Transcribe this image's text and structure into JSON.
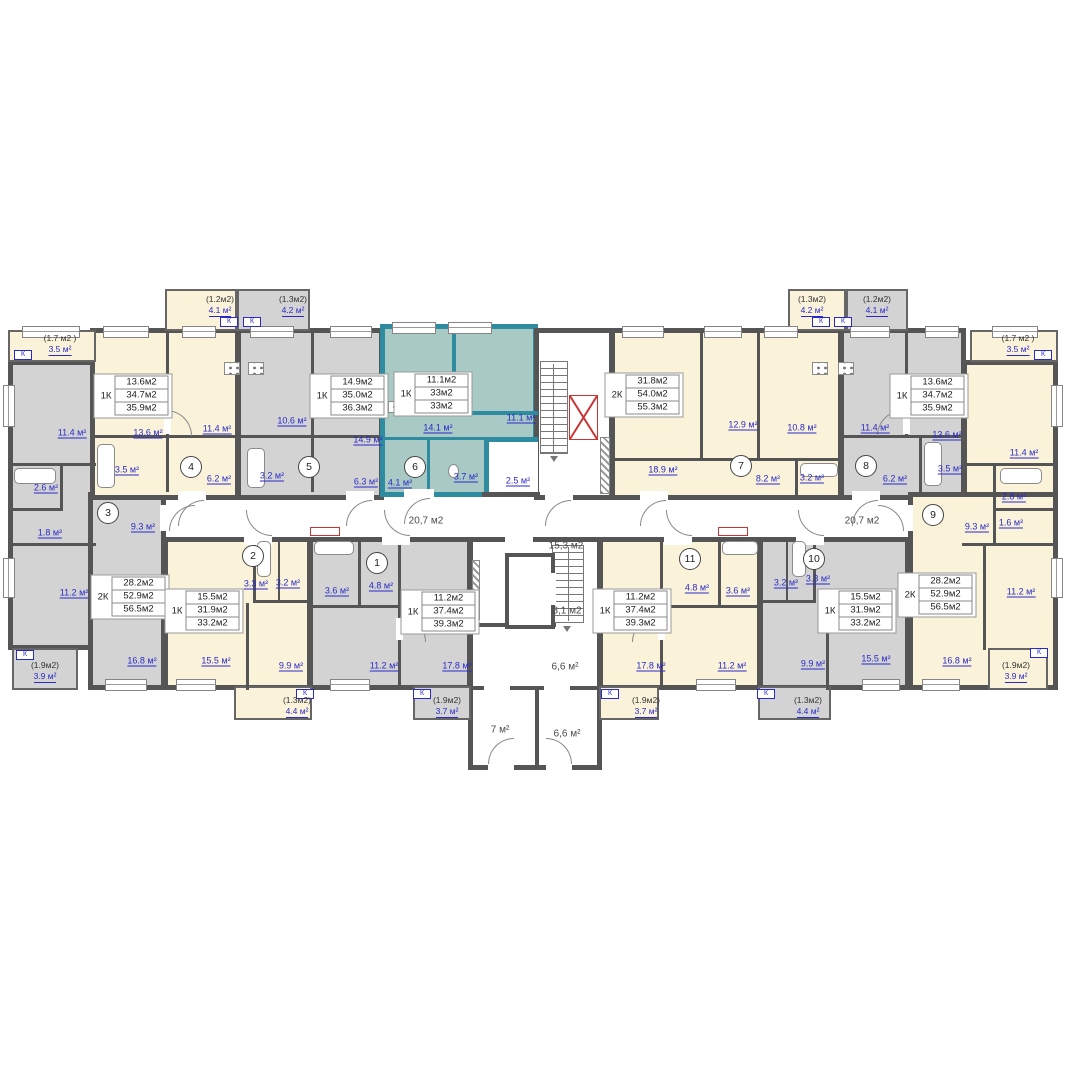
{
  "plan": {
    "units": {
      "1": {
        "num": "1",
        "kind": "1К",
        "table": [
          "11.2м2",
          "37.4м2",
          "39.3м2"
        ],
        "rooms": [
          "3.6 м²",
          "4.8 м²",
          "11.2 м²",
          "17.8 м²"
        ],
        "balcony_head": "(1.9м2)",
        "balcony_area": "3.7 м²"
      },
      "2": {
        "num": "2",
        "kind": "1К",
        "table": [
          "15.5м2",
          "31.9м2",
          "33.2м2"
        ],
        "rooms": [
          "3.3 м²",
          "3.2 м²",
          "9.9 м²",
          "15.5 м²"
        ],
        "balcony_head": "(1.3м2)",
        "balcony_area": "4.4 м²"
      },
      "3": {
        "num": "3",
        "kind": "2К",
        "table": [
          "28.2м2",
          "52.9м2",
          "56.5м2"
        ],
        "rooms": [
          "11.4 м²",
          "2.6 м²",
          "1.8 м²",
          "9.3 м²",
          "11.2 м²",
          "16.8 м²"
        ],
        "balcony_head": "(1.9м2)",
        "balcony_area": "3.9 м²"
      },
      "4": {
        "num": "4",
        "kind": "1К",
        "table": [
          "13.6м2",
          "34.7м2",
          "35.9м2"
        ],
        "rooms": [
          "13.6 м²",
          "11.4 м²",
          "3.5 м²",
          "6.2 м²"
        ],
        "balcony_head": "(1.2м2)",
        "balcony_area": "4.1 м²"
      },
      "5": {
        "num": "5",
        "kind": "1К",
        "table": [
          "14.9м2",
          "35.0м2",
          "36.3м2"
        ],
        "rooms": [
          "10.6 м²",
          "14.9 м²",
          "3.2 м²",
          "6.3 м²"
        ],
        "balcony_head": "(1.3м2)",
        "balcony_area": "4.2 м²"
      },
      "6": {
        "num": "6",
        "kind": "1К",
        "table": [
          "11.1м2",
          "33м2",
          "33м2"
        ],
        "rooms": [
          "14.1 м²",
          "11.1 м²",
          "4.1 м²",
          "3.7 м²"
        ]
      },
      "7": {
        "num": "7",
        "kind": "2К",
        "table": [
          "31.8м2",
          "54.0м2",
          "55.3м2"
        ],
        "rooms": [
          "18.9 м²",
          "12.9 м²",
          "10.8 м²",
          "8.2 м²",
          "3.2 м²"
        ],
        "balcony_head": "(1.3м2)",
        "balcony_area": "4.2 м²"
      },
      "8": {
        "num": "8",
        "kind": "1К",
        "table": [
          "13.6м2",
          "34.7м2",
          "35.9м2"
        ],
        "rooms": [
          "11.4 м²",
          "13.6 м²",
          "6.2 м²",
          "3.5 м²"
        ],
        "balcony_head": "(1.2м2)",
        "balcony_area": "4.1 м²"
      },
      "9": {
        "num": "9",
        "kind": "2К",
        "table": [
          "28.2м2",
          "52.9м2",
          "56.5м2"
        ],
        "rooms": [
          "11.4 м²",
          "2.8 м²",
          "1.6 м²",
          "9.3 м²",
          "11.2 м²",
          "16.8 м²"
        ],
        "balcony_head": "(1.9м2)",
        "balcony_area": "3.9 м²"
      },
      "10": {
        "num": "10",
        "kind": "1К",
        "table": [
          "15.5м2",
          "31.9м2",
          "33.2м2"
        ],
        "rooms": [
          "3.2 м²",
          "3.3 м²",
          "9.9 м²",
          "15.5 м²"
        ],
        "balcony_head": "(1.3м2)",
        "balcony_area": "4.4 м²"
      },
      "11": {
        "num": "11",
        "kind": "1К",
        "table": [
          "11.2м2",
          "37.4м2",
          "39.3м2"
        ],
        "rooms": [
          "4.8 м²",
          "3.6 м²",
          "11.2 м²",
          "17.8 м²"
        ],
        "balcony_head": "(1.9м2)",
        "balcony_area": "3.7 м²"
      }
    },
    "corners": {
      "tl_head": "(1.7 м2 )",
      "tl_area": "3.5 м²",
      "tr_head": "(1.7 м2 )",
      "tr_area": "3.5 м²"
    },
    "common": {
      "hall_left": "20,7 м2",
      "hall_right": "20,7 м2",
      "stair": "15,3 м2",
      "landing": "3,1 м2",
      "lobby_upper": "6,6 м²",
      "lobby_lower": "6,6 м²",
      "vestibule": "7 м²",
      "entry": "2.5 м²"
    },
    "k_mark": "К",
    "colors": {
      "highlight": "#2e8ba0",
      "highlight_fill": "#a9c9c5",
      "cream": "#faf3d9",
      "gray": "#d3d3d3",
      "wall": "#555555",
      "label_blue": "#2a2ac8",
      "red": "#cc3333"
    }
  }
}
